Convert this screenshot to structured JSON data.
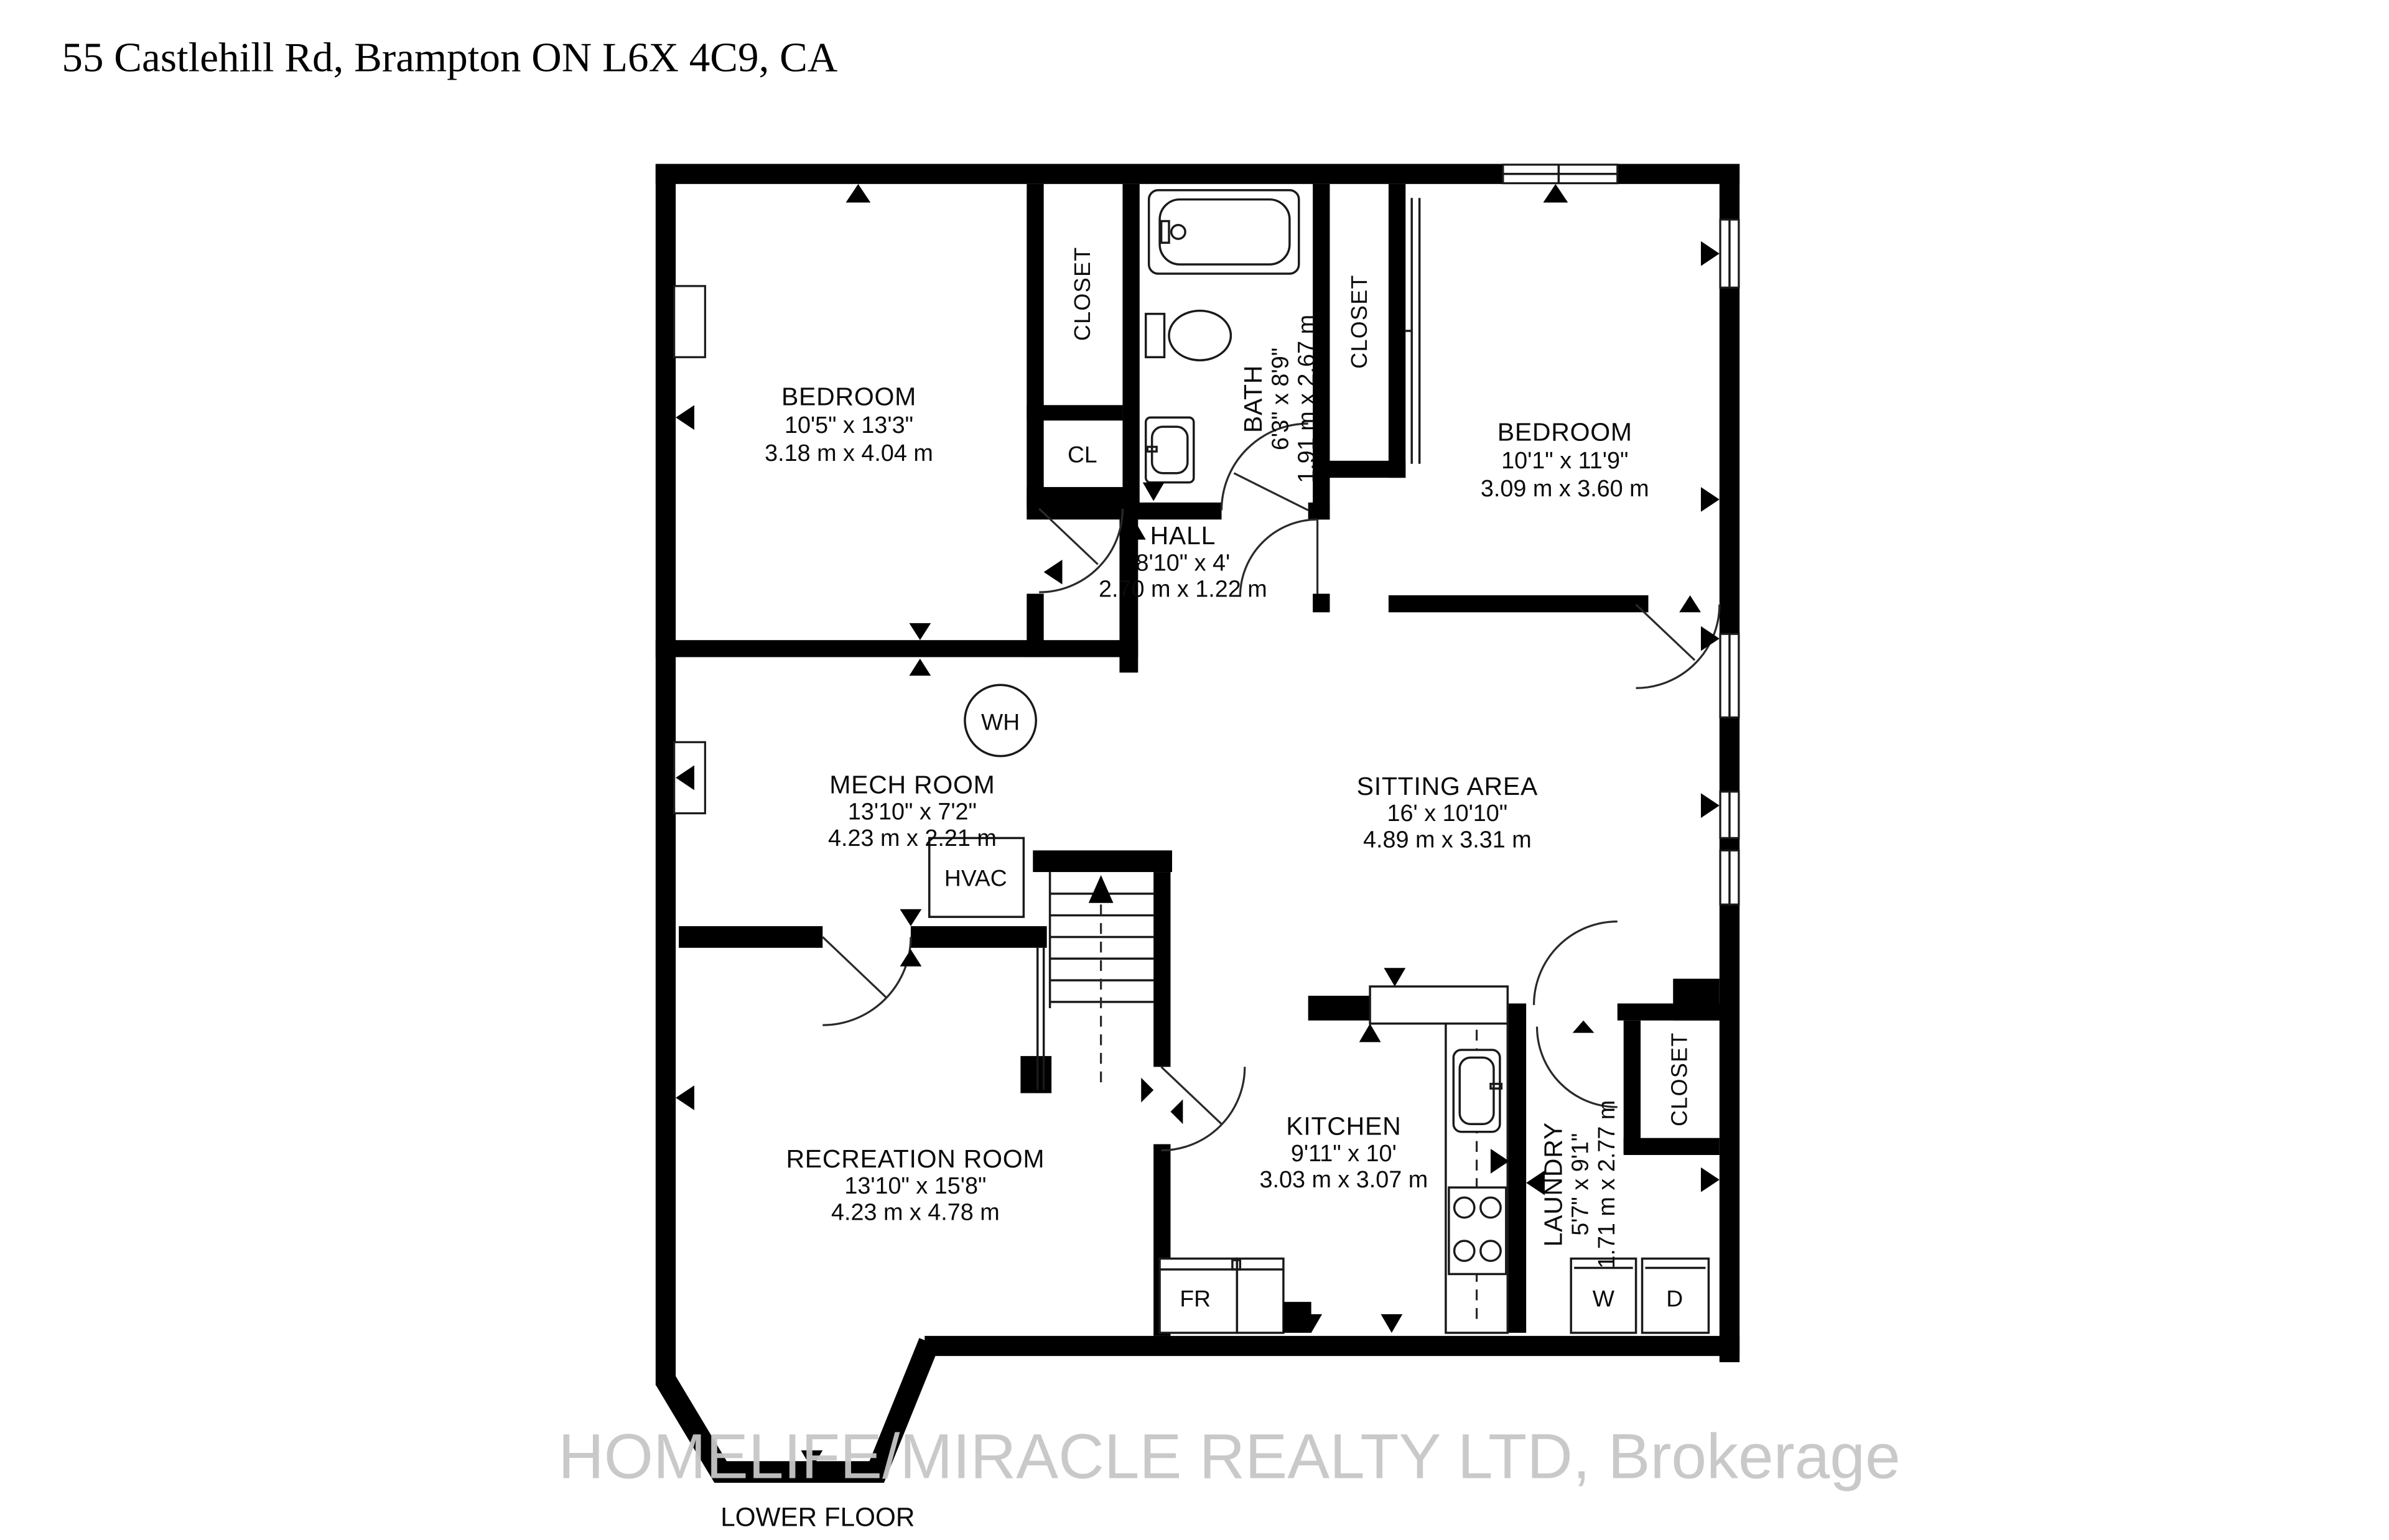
{
  "header": {
    "address": "55 Castlehill Rd, Brampton ON L6X 4C9, CA"
  },
  "plan": {
    "floor_label": "LOWER FLOOR",
    "watermark": "HOMELIFE/MIRACLE REALTY LTD, Brokerage",
    "rooms": {
      "bedroom_left": {
        "name": "BEDROOM",
        "imperial": "10'5\" x 13'3\"",
        "metric": "3.18 m x 4.04 m"
      },
      "bedroom_right": {
        "name": "BEDROOM",
        "imperial": "10'1\" x 11'9\"",
        "metric": "3.09 m x 3.60 m"
      },
      "bath": {
        "name": "BATH",
        "imperial": "6'3\" x 8'9\"",
        "metric": "1.91 m x 2.67 m"
      },
      "hall": {
        "name": "HALL",
        "imperial": "8'10\" x 4'",
        "metric": "2.70 m x 1.22 m"
      },
      "mech": {
        "name": "MECH ROOM",
        "imperial": "13'10\" x 7'2\"",
        "metric": "4.23 m x 2.21 m"
      },
      "sitting": {
        "name": "SITTING AREA",
        "imperial": "16' x 10'10\"",
        "metric": "4.89 m x 3.31 m"
      },
      "recreation": {
        "name": "RECREATION ROOM",
        "imperial": "13'10\" x 15'8\"",
        "metric": "4.23 m x 4.78 m"
      },
      "kitchen": {
        "name": "KITCHEN",
        "imperial": "9'11\" x 10'",
        "metric": "3.03 m x 3.07 m"
      },
      "laundry": {
        "name": "LAUNDRY",
        "imperial": "5'7\" x 9'1\"",
        "metric": "1.71 m x 2.77 m"
      }
    },
    "labels": {
      "closet_upper": "CLOSET",
      "closet_bedroom": "CLOSET",
      "closet_laundry": "CLOSET",
      "cl": "CL",
      "water_heater": "WH",
      "hvac": "HVAC",
      "fridge": "FR",
      "washer": "W",
      "dryer": "D"
    },
    "colors": {
      "walls": "#000000",
      "watermark": "#c7c7c7",
      "background": "#ffffff"
    }
  }
}
